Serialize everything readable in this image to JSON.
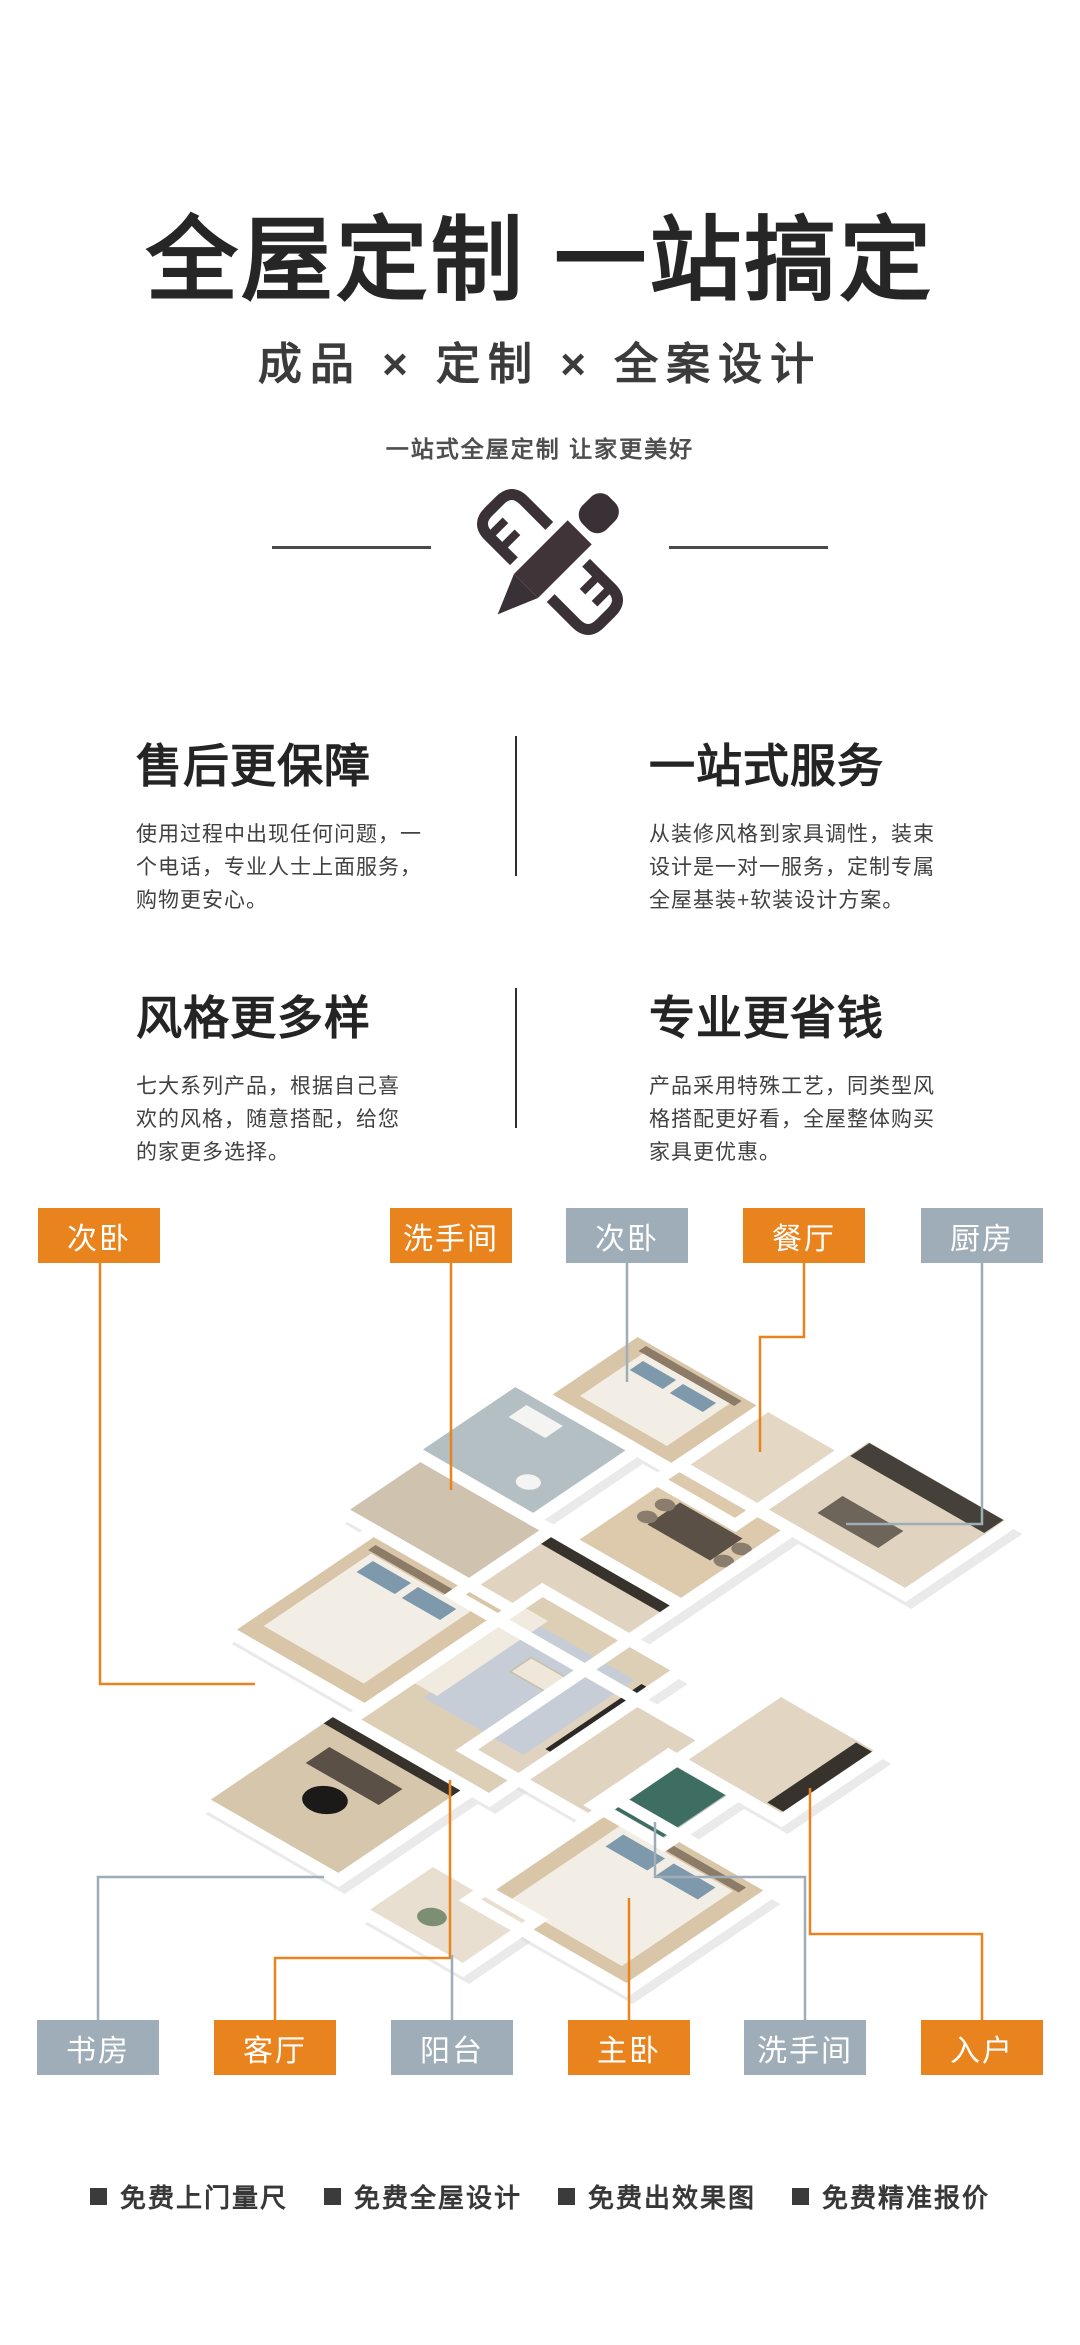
{
  "header": {
    "title": "全屋定制 一站搞定",
    "subtitle": "成品 × 定制 × 全案设计",
    "tagline": "一站式全屋定制 让家更美好"
  },
  "features": [
    {
      "title": "售后更保障",
      "desc": "使用过程中出现任何问题，一个电话，专业人士上面服务，购物更安心。"
    },
    {
      "title": "一站式服务",
      "desc": "从装修风格到家具调性，装束设计是一对一服务，定制专属全屋基装+软装设计方案。"
    },
    {
      "title": "风格更多样",
      "desc": "七大系列产品，根据自己喜欢的风格，随意搭配，给您的家更多选择。"
    },
    {
      "title": "专业更省钱",
      "desc": "产品采用特殊工艺，同类型风格搭配更好看，全屋整体购买家具更优惠。"
    }
  ],
  "floor_plan": {
    "labels_top": [
      {
        "label": "次卧",
        "style": "orange"
      },
      {
        "label": "洗手间",
        "style": "orange"
      },
      {
        "label": "次卧",
        "style": "gray"
      },
      {
        "label": "餐厅",
        "style": "orange"
      },
      {
        "label": "厨房",
        "style": "gray"
      }
    ],
    "labels_bottom": [
      {
        "label": "书房",
        "style": "gray"
      },
      {
        "label": "客厅",
        "style": "orange"
      },
      {
        "label": "阳台",
        "style": "gray"
      },
      {
        "label": "主卧",
        "style": "orange"
      },
      {
        "label": "洗手间",
        "style": "gray"
      },
      {
        "label": "入户",
        "style": "orange"
      }
    ]
  },
  "footer": {
    "items": [
      "免费上门量尺",
      "免费全屋设计",
      "免费出效果图",
      "免费精准报价"
    ]
  },
  "icons": {
    "center_icon": "pencil-ruler-icon"
  },
  "colors": {
    "accent_orange": "#E8831D",
    "label_gray_blue": "#9FADB8",
    "heading_text": "#262626",
    "body_text": "#414141"
  }
}
